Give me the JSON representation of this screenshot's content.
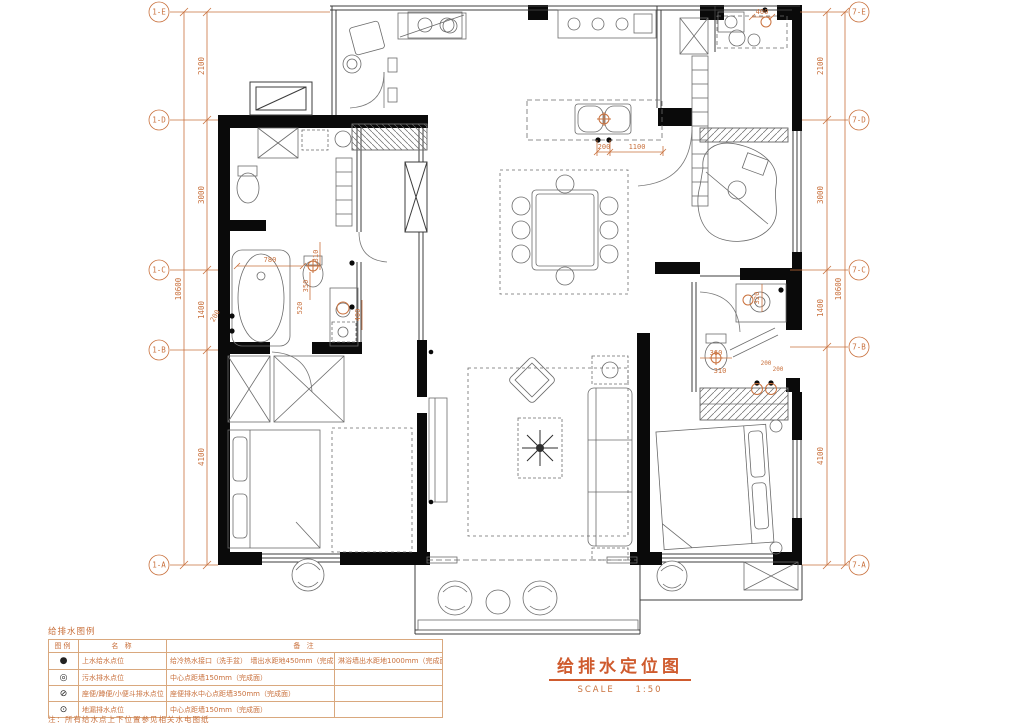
{
  "drawing": {
    "title": "给排水定位图",
    "scale_label": "SCALE",
    "scale_value": "1:50"
  },
  "grid": {
    "left": [
      "1-E",
      "1-D",
      "1-C",
      "1-B",
      "1-A"
    ],
    "right": [
      "7-E",
      "7-D",
      "7-C",
      "7-B",
      "7-A"
    ]
  },
  "dimensions": {
    "left": {
      "segments": [
        "2100",
        "3000",
        "1400",
        "4100"
      ],
      "total": "10600"
    },
    "right": {
      "segments": [
        "2100",
        "3000",
        "1400",
        "4100"
      ],
      "total": "10600"
    }
  },
  "annotations": {
    "kitchen": [
      "200",
      "1100"
    ],
    "bath1": [
      "780",
      "310",
      "350",
      "520",
      "400",
      "200"
    ],
    "bath2": [
      "320",
      "360",
      "310",
      "200",
      "200"
    ],
    "utility": [
      "400"
    ]
  },
  "legend": {
    "title": "给排水图例",
    "headers": {
      "symbol": "图例",
      "name": "名  称",
      "remark": "备  注"
    },
    "rows": [
      {
        "symbol": "●",
        "name": "上水给水点位",
        "remark": "给冷热水接口（洗手盆）　墙出水距地450mm（完成面）",
        "remark2": "淋浴墙出水距地1000mm（完成面）"
      },
      {
        "symbol": "◎",
        "name": "污水排水点位",
        "remark": "中心点距墙150mm（完成面）",
        "remark2": ""
      },
      {
        "symbol": "⊘",
        "name": "座便/蹲便/小便斗排水点位",
        "remark": "座便排水中心点距墙350mm（完成面）",
        "remark2": ""
      },
      {
        "symbol": "⊙",
        "name": "地漏排水点位",
        "remark": "中心点距墙150mm（完成面）",
        "remark2": ""
      }
    ],
    "note": "注：所有给水点上下位置参见相关水电图纸"
  },
  "colors": {
    "accent": "#c9713d",
    "wall": "#0a0a0a",
    "line": "#555555"
  }
}
